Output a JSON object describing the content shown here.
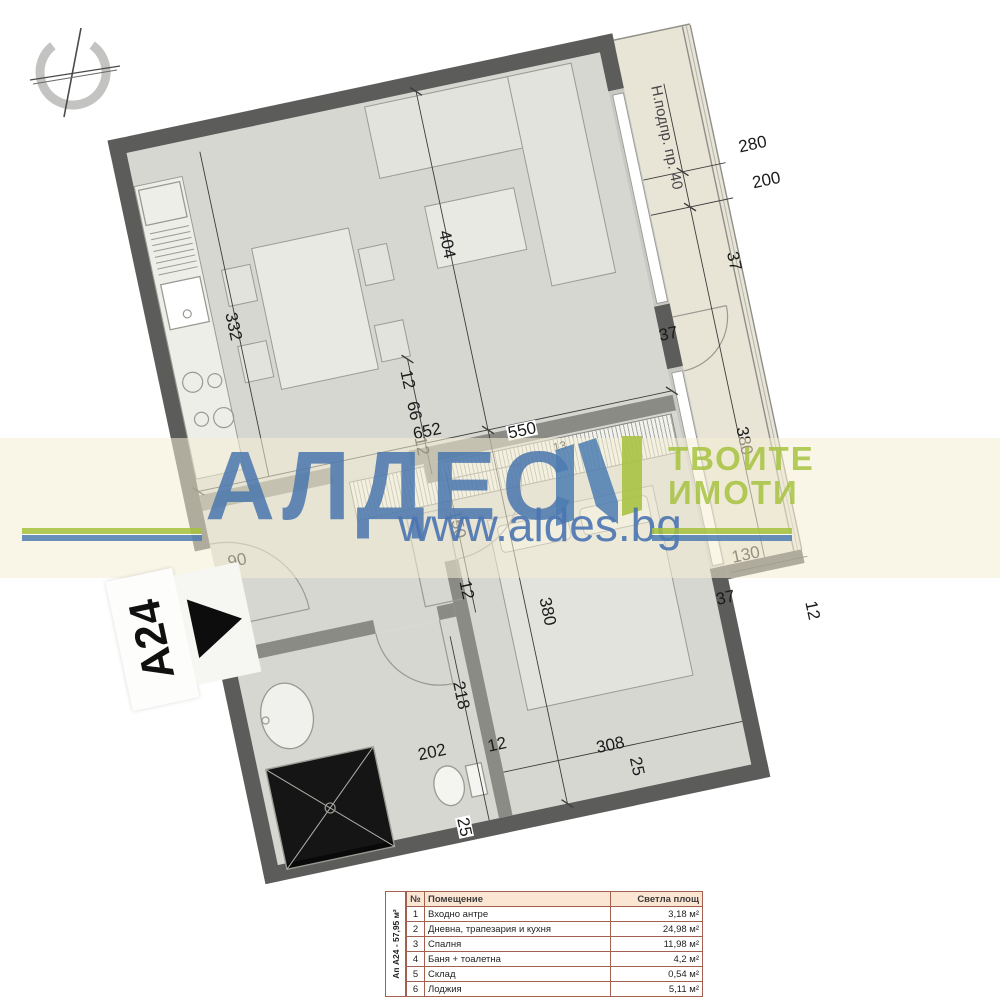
{
  "watermark": {
    "brand": "АЛДЕС",
    "tagline1": "ТВОИТЕ",
    "tagline2": "ИМОТИ",
    "website": "www.aldes.bg",
    "brand_blue": "#4d7db2",
    "accent_green": "#a6c13c"
  },
  "unit_tag": {
    "label": "A24"
  },
  "plan": {
    "window_note": "Н.подпр. пр. 40",
    "dims": {
      "loggia_top_a": "280",
      "loggia_top_b": "200",
      "loggia_top_t": "37",
      "pillar_t": "37",
      "living_h": "404",
      "living_w": "652",
      "kitchen_w": "332",
      "wardrobe_w": "550",
      "wardrobe_t": "13",
      "entry_w": "90",
      "shaft_a": "12",
      "shaft_b": "66",
      "shaft_c": "12",
      "hall_w": "150",
      "hall_t": "12",
      "bath_h": "218",
      "bath_w": "202",
      "wc_off": "12",
      "bath_wall": "25",
      "bedroom_h": "380",
      "bedroom_w": "308",
      "bedroom_wall": "25",
      "bedroom_t": "37",
      "loggia_right_h": "380",
      "loggia_right_w": "130",
      "loggia_right_t": "12"
    }
  },
  "table": {
    "unit_summary": "Ап А24 - 57,95 м²",
    "headers": {
      "num": "№",
      "room": "Помещение",
      "area": "Светла площ"
    },
    "rows": [
      {
        "num": "1",
        "room": "Входно антре",
        "area": "3,18 м²"
      },
      {
        "num": "2",
        "room": "Дневна, трапезария и кухня",
        "area": "24,98 м²"
      },
      {
        "num": "3",
        "room": "Спалня",
        "area": "11,98 м²"
      },
      {
        "num": "4",
        "room": "Баня + тоалетна",
        "area": "4,2 м²"
      },
      {
        "num": "5",
        "room": "Склад",
        "area": "0,54 м²"
      },
      {
        "num": "6",
        "room": "Лоджия",
        "area": "5,11 м²"
      }
    ]
  }
}
